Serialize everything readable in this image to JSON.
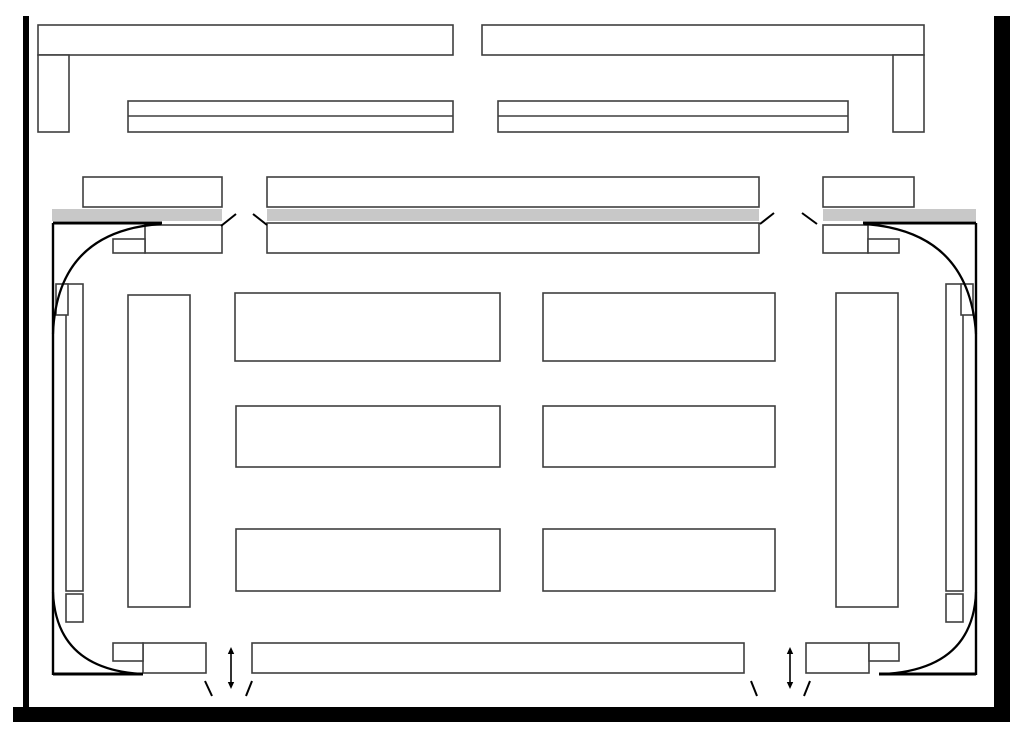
{
  "palette": {
    "white": "#ffffff",
    "outline": "#3f3f3f",
    "thick": "#000000",
    "frame": "#000000",
    "platform": "#c8c8c8"
  },
  "drawing": {
    "viewbox": "0 0 1022 729",
    "layers": [
      {
        "name": "slide-frame",
        "items": [
          {
            "t": "rect",
            "n": "frame-border-left",
            "x": 23,
            "y": 16,
            "w": 6,
            "h": 706,
            "f": "frame",
            "s": "none"
          },
          {
            "t": "rect",
            "n": "frame-border-right",
            "x": 994,
            "y": 16,
            "w": 16,
            "h": 706,
            "f": "frame",
            "s": "none"
          },
          {
            "t": "rect",
            "n": "frame-border-bottom",
            "x": 13,
            "y": 707,
            "w": 997,
            "h": 15,
            "f": "frame",
            "s": "none"
          }
        ]
      },
      {
        "name": "top-bars",
        "items": [
          {
            "t": "rect",
            "n": "top-left-bar",
            "x": 38,
            "y": 25,
            "w": 415,
            "h": 30
          },
          {
            "t": "rect",
            "n": "top-left-leg",
            "x": 38,
            "y": 55,
            "w": 31,
            "h": 77
          },
          {
            "t": "rect",
            "n": "left-double-bar",
            "x": 128,
            "y": 101,
            "w": 325,
            "h": 31
          },
          {
            "t": "line",
            "n": "left-double-bar-divider",
            "x1": 128,
            "y1": 116,
            "x2": 453,
            "y2": 116
          },
          {
            "t": "rect",
            "n": "top-right-bar",
            "x": 482,
            "y": 25,
            "w": 442,
            "h": 30
          },
          {
            "t": "rect",
            "n": "top-right-leg",
            "x": 893,
            "y": 55,
            "w": 31,
            "h": 77
          },
          {
            "t": "rect",
            "n": "right-double-bar",
            "x": 498,
            "y": 101,
            "w": 350,
            "h": 31
          },
          {
            "t": "line",
            "n": "right-double-bar-divider",
            "x1": 498,
            "y1": 116,
            "x2": 848,
            "y2": 116
          }
        ]
      },
      {
        "name": "platform-row",
        "items": [
          {
            "t": "rect",
            "n": "upper-box-left",
            "x": 83,
            "y": 177,
            "w": 139,
            "h": 30
          },
          {
            "t": "rect",
            "n": "upper-box-center",
            "x": 267,
            "y": 177,
            "w": 492,
            "h": 30
          },
          {
            "t": "rect",
            "n": "upper-box-right",
            "x": 823,
            "y": 177,
            "w": 91,
            "h": 30
          },
          {
            "t": "rect",
            "n": "platform-strip-left",
            "x": 52,
            "y": 209,
            "w": 170,
            "h": 12,
            "f": "platform",
            "s": "none"
          },
          {
            "t": "rect",
            "n": "platform-strip-center",
            "x": 267,
            "y": 209,
            "w": 492,
            "h": 12,
            "f": "platform",
            "s": "none"
          },
          {
            "t": "rect",
            "n": "platform-strip-right",
            "x": 823,
            "y": 209,
            "w": 153,
            "h": 12,
            "f": "platform",
            "s": "none"
          },
          {
            "t": "rect",
            "n": "lower-box-center",
            "x": 267,
            "y": 223,
            "w": 492,
            "h": 30
          },
          {
            "t": "rect",
            "n": "lower-box-left",
            "x": 145,
            "y": 225,
            "w": 77,
            "h": 28
          },
          {
            "t": "rect",
            "n": "lower-box-left-sub",
            "x": 113,
            "y": 239,
            "w": 32,
            "h": 14
          },
          {
            "t": "rect",
            "n": "lower-box-right",
            "x": 823,
            "y": 225,
            "w": 45,
            "h": 28
          },
          {
            "t": "rect",
            "n": "lower-box-right-sub",
            "x": 868,
            "y": 239,
            "w": 31,
            "h": 14
          },
          {
            "t": "line",
            "n": "break-mark-top-left-a",
            "x1": 221,
            "y1": 226,
            "x2": 236,
            "y2": 214,
            "c": "thick",
            "lw": 2
          },
          {
            "t": "line",
            "n": "break-mark-top-left-b",
            "x1": 253,
            "y1": 214,
            "x2": 267,
            "y2": 225,
            "c": "thick",
            "lw": 2
          },
          {
            "t": "line",
            "n": "break-mark-top-right-a",
            "x1": 760,
            "y1": 224,
            "x2": 774,
            "y2": 213,
            "c": "thick",
            "lw": 2
          },
          {
            "t": "line",
            "n": "break-mark-top-right-b",
            "x1": 802,
            "y1": 213,
            "x2": 817,
            "y2": 224,
            "c": "thick",
            "lw": 2
          }
        ]
      },
      {
        "name": "side-columns",
        "items": [
          {
            "t": "rect",
            "n": "left-narrow-rect",
            "x": 66,
            "y": 284,
            "w": 17,
            "h": 307
          },
          {
            "t": "rect",
            "n": "left-cap-box",
            "x": 56,
            "y": 284,
            "w": 12,
            "h": 31
          },
          {
            "t": "rect",
            "n": "left-end-box",
            "x": 66,
            "y": 594,
            "w": 17,
            "h": 28
          },
          {
            "t": "rect",
            "n": "left-tall-rect",
            "x": 128,
            "y": 295,
            "w": 62,
            "h": 312
          },
          {
            "t": "rect",
            "n": "right-narrow-rect",
            "x": 946,
            "y": 284,
            "w": 17,
            "h": 307
          },
          {
            "t": "rect",
            "n": "right-cap-box",
            "x": 961,
            "y": 284,
            "w": 12,
            "h": 31
          },
          {
            "t": "rect",
            "n": "right-end-box",
            "x": 946,
            "y": 594,
            "w": 17,
            "h": 28
          },
          {
            "t": "rect",
            "n": "right-tall-rect",
            "x": 836,
            "y": 293,
            "w": 62,
            "h": 314
          }
        ]
      },
      {
        "name": "center-grid",
        "items": [
          {
            "t": "rect",
            "n": "grid-box-row1-left",
            "x": 235,
            "y": 293,
            "w": 265,
            "h": 68
          },
          {
            "t": "rect",
            "n": "grid-box-row1-right",
            "x": 543,
            "y": 293,
            "w": 232,
            "h": 68
          },
          {
            "t": "rect",
            "n": "grid-box-row2-left",
            "x": 236,
            "y": 406,
            "w": 264,
            "h": 61
          },
          {
            "t": "rect",
            "n": "grid-box-row2-right",
            "x": 543,
            "y": 406,
            "w": 232,
            "h": 61
          },
          {
            "t": "rect",
            "n": "grid-box-row3-left",
            "x": 236,
            "y": 529,
            "w": 264,
            "h": 62
          },
          {
            "t": "rect",
            "n": "grid-box-row3-right",
            "x": 543,
            "y": 529,
            "w": 232,
            "h": 62
          }
        ]
      },
      {
        "name": "bottom-row",
        "items": [
          {
            "t": "rect",
            "n": "bottom-bar",
            "x": 252,
            "y": 643,
            "w": 492,
            "h": 30
          },
          {
            "t": "rect",
            "n": "bottom-left-box",
            "x": 143,
            "y": 643,
            "w": 63,
            "h": 30
          },
          {
            "t": "rect",
            "n": "bottom-left-sub",
            "x": 113,
            "y": 643,
            "w": 30,
            "h": 18
          },
          {
            "t": "rect",
            "n": "bottom-right-box",
            "x": 806,
            "y": 643,
            "w": 63,
            "h": 30
          },
          {
            "t": "rect",
            "n": "bottom-right-sub",
            "x": 869,
            "y": 643,
            "w": 30,
            "h": 18
          },
          {
            "t": "varrow",
            "n": "clearance-arrow-left",
            "x": 231,
            "y1": 647,
            "y2": 689
          },
          {
            "t": "varrow",
            "n": "clearance-arrow-right",
            "x": 790,
            "y1": 647,
            "y2": 689
          },
          {
            "t": "line",
            "n": "break-mark-bottom-left-a",
            "x1": 205,
            "y1": 681,
            "x2": 212,
            "y2": 696,
            "c": "thick",
            "lw": 2
          },
          {
            "t": "line",
            "n": "break-mark-bottom-left-b",
            "x1": 246,
            "y1": 696,
            "x2": 252,
            "y2": 681,
            "c": "thick",
            "lw": 2
          },
          {
            "t": "line",
            "n": "break-mark-bottom-right-a",
            "x1": 751,
            "y1": 681,
            "x2": 757,
            "y2": 696,
            "c": "thick",
            "lw": 2
          },
          {
            "t": "line",
            "n": "break-mark-bottom-right-b",
            "x1": 804,
            "y1": 696,
            "x2": 810,
            "y2": 681,
            "c": "thick",
            "lw": 2
          }
        ]
      },
      {
        "name": "corner-curves",
        "items": [
          {
            "t": "line",
            "n": "corner-line-left",
            "x1": 53,
            "y1": 223,
            "x2": 53,
            "y2": 675,
            "c": "thick",
            "lw": 2.4
          },
          {
            "t": "line",
            "n": "corner-line-right",
            "x1": 976,
            "y1": 223,
            "x2": 976,
            "y2": 675,
            "c": "thick",
            "lw": 2.4
          },
          {
            "t": "line",
            "n": "approach-line-top-left",
            "x1": 53,
            "y1": 223,
            "x2": 162,
            "y2": 223,
            "c": "thick",
            "lw": 3
          },
          {
            "t": "line",
            "n": "approach-line-top-right",
            "x1": 863,
            "y1": 223,
            "x2": 976,
            "y2": 223,
            "c": "thick",
            "lw": 3
          },
          {
            "t": "line",
            "n": "approach-line-bottom-left",
            "x1": 53,
            "y1": 674,
            "x2": 143,
            "y2": 674,
            "c": "thick",
            "lw": 3
          },
          {
            "t": "line",
            "n": "approach-line-bottom-right",
            "x1": 879,
            "y1": 674,
            "x2": 976,
            "y2": 674,
            "c": "thick",
            "lw": 3
          },
          {
            "t": "curve",
            "n": "corner-curve-top-left",
            "p": [
              161,
              224,
              57,
              231,
              53,
              334
            ],
            "c": "thick",
            "lw": 2.2
          },
          {
            "t": "curve",
            "n": "corner-curve-top-right",
            "p": [
              864,
              224,
              969,
              231,
              976,
              334
            ],
            "c": "thick",
            "lw": 2.2
          },
          {
            "t": "curve",
            "n": "corner-curve-bottom-left",
            "p": [
              53,
              592,
              56,
              669,
              142,
              674
            ],
            "c": "thick",
            "lw": 2.2
          },
          {
            "t": "curve",
            "n": "corner-curve-bottom-right",
            "p": [
              976,
              592,
              973,
              669,
              884,
              674
            ],
            "c": "thick",
            "lw": 2.2
          }
        ]
      }
    ]
  }
}
